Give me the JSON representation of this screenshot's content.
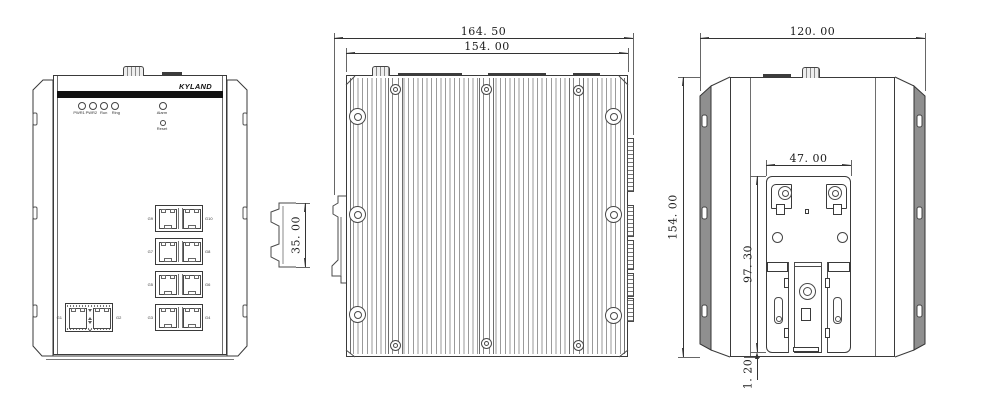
{
  "colors": {
    "line": "#3a3a3a",
    "thin_line": "#6e6e6e",
    "dark_fill": "#111111",
    "flange_gray": "#8f8f8f",
    "background": "#ffffff"
  },
  "brand": "KYLAND",
  "front_view": {
    "leds": [
      "PWR1",
      "PWR2",
      "Run",
      "Ring"
    ],
    "alarm_label": "Alarm",
    "reset_label": "Reset",
    "port_rows": [
      {
        "left": "G9",
        "right": "G10"
      },
      {
        "left": "G7",
        "right": "G8"
      },
      {
        "left": "G5",
        "right": "G6"
      },
      {
        "left": "G3",
        "right": "G4"
      }
    ],
    "sfp_labels": {
      "left": "G1",
      "right": "G2"
    }
  },
  "side_view": {
    "dim_overall_width": "164. 50",
    "dim_body_width": "154. 00",
    "dim_din_rail": "35. 00"
  },
  "rear_view": {
    "dim_width": "120. 00",
    "dim_height": "154. 00",
    "dim_mount_span": "47. 00",
    "dim_plate_height": "97. 30",
    "dim_bottom_gap": "1. 20"
  }
}
